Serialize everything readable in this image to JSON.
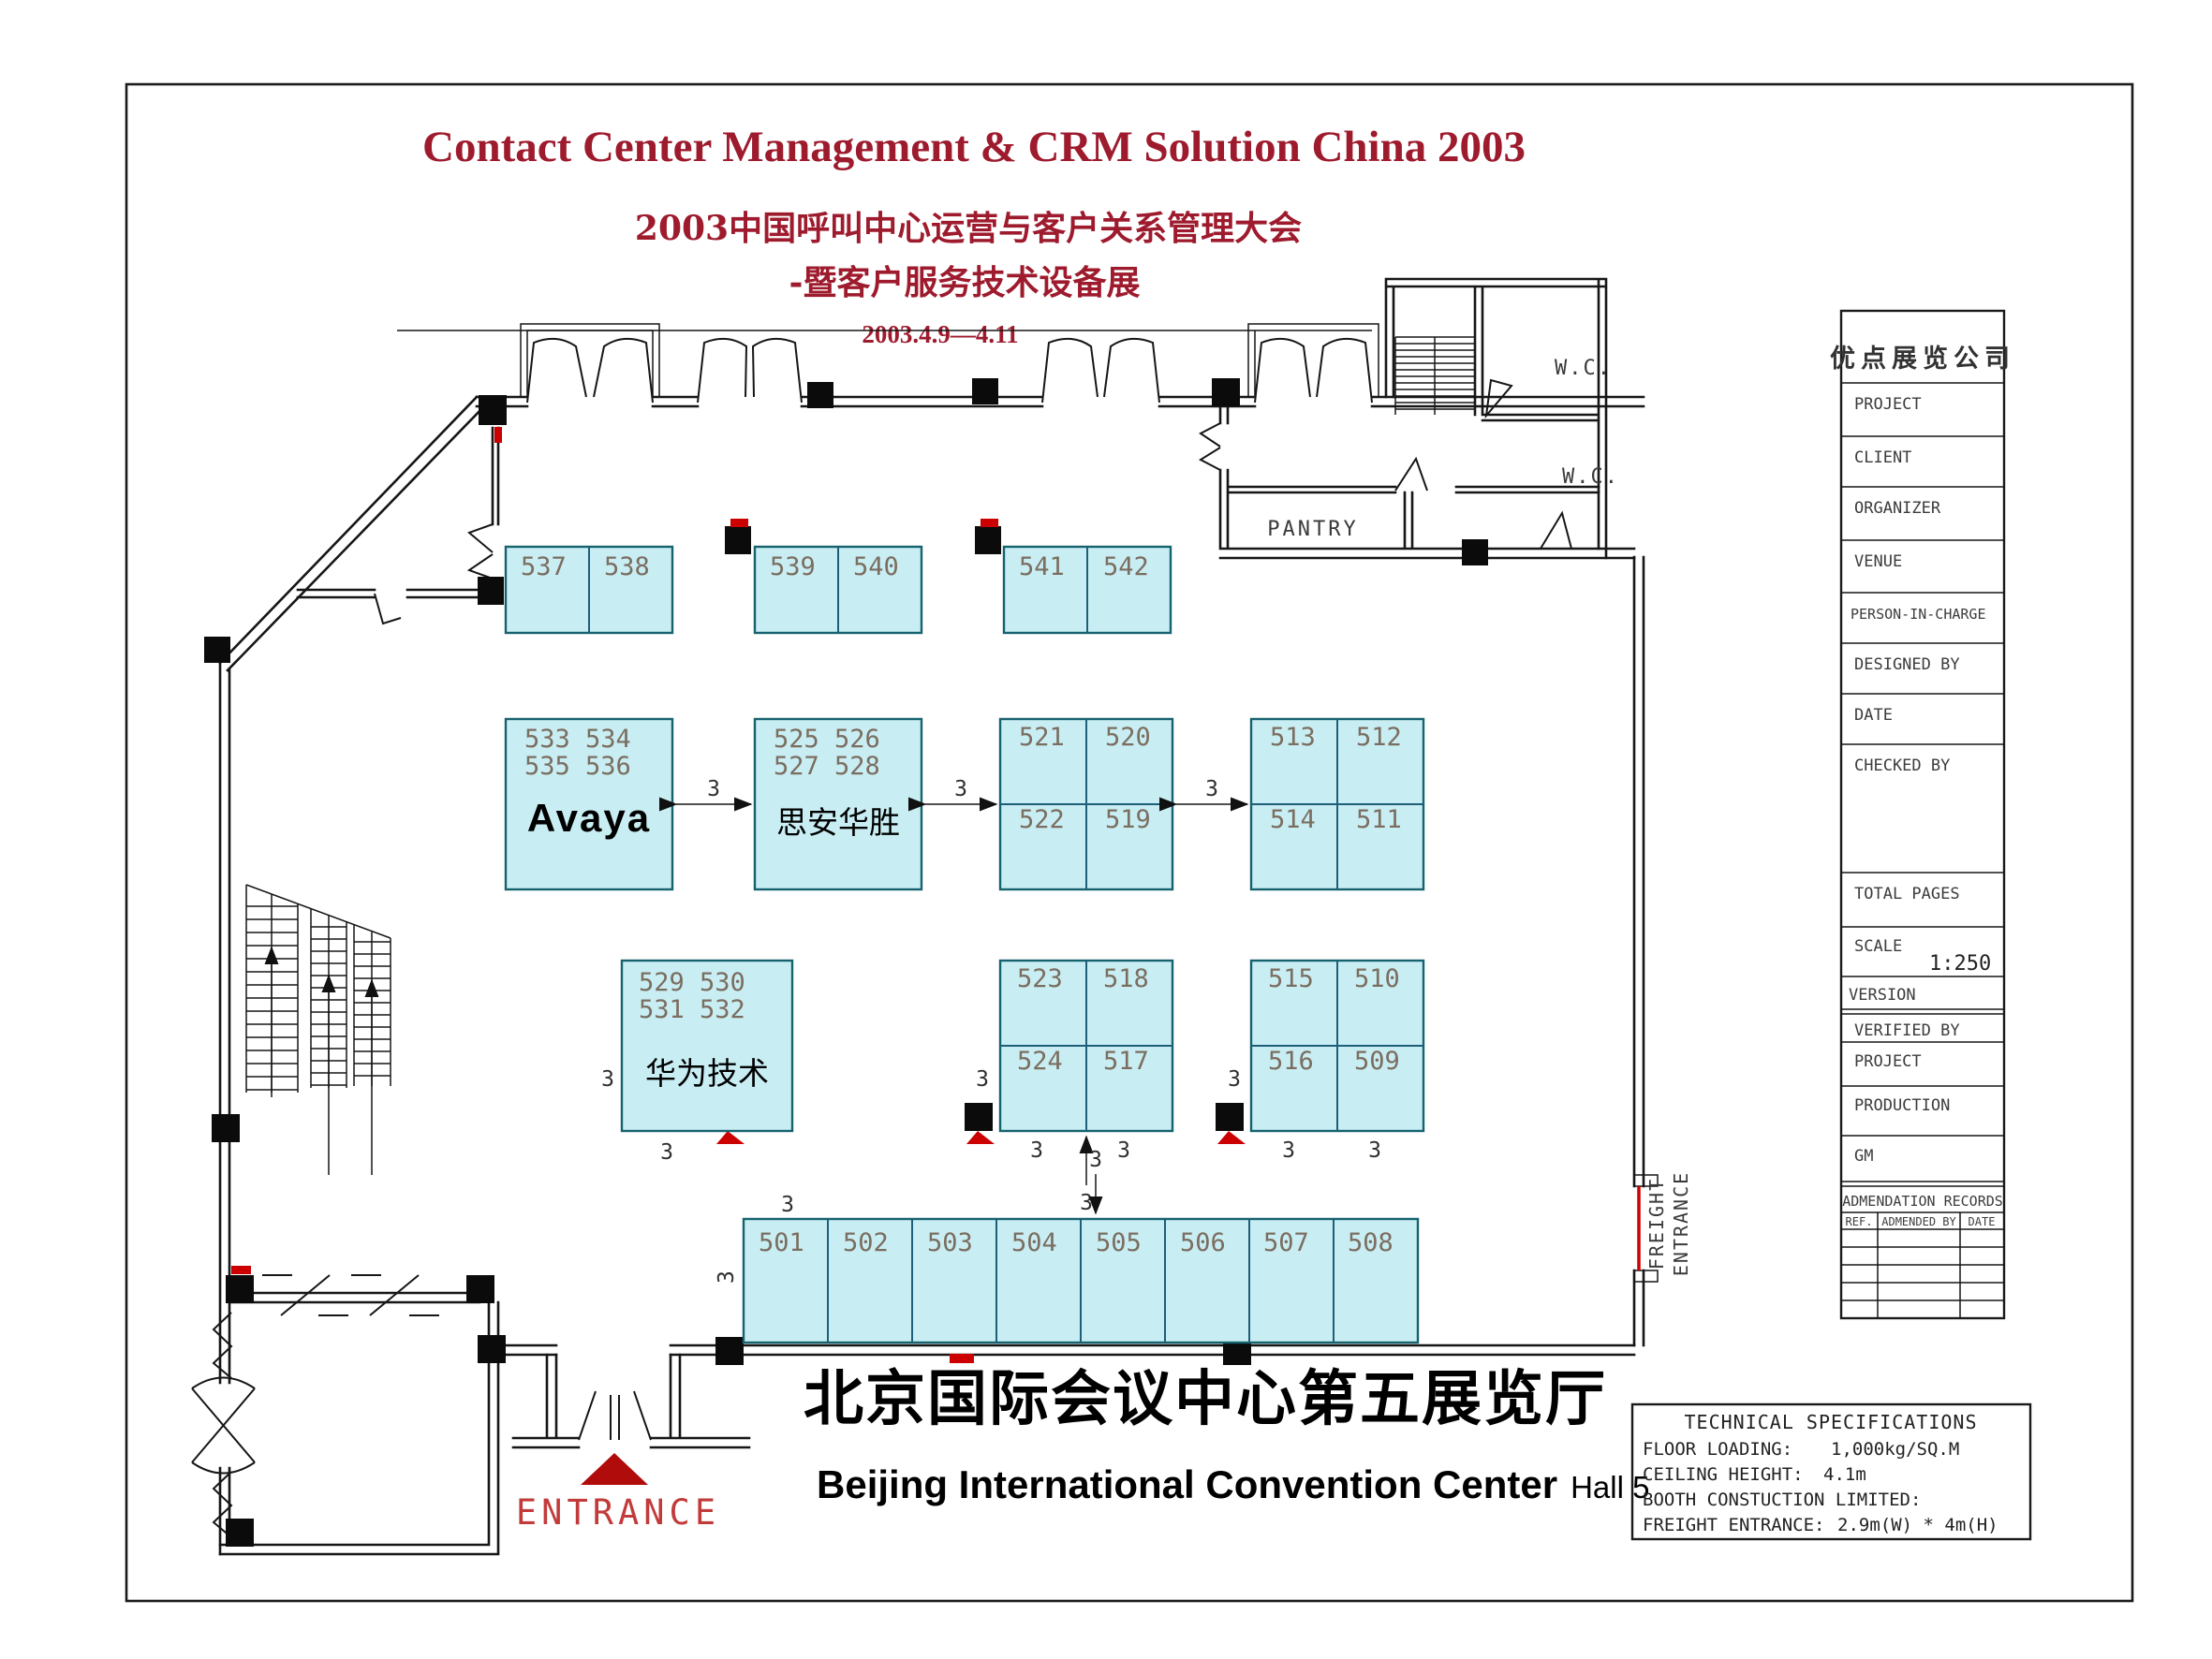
{
  "header": {
    "title": "Contact Center Management & CRM Solution China 2003",
    "subtitle1": "2003中国呼叫中心运营与客户关系管理大会",
    "subtitle2": "-暨客户服务技术设备展",
    "dates": "2003.4.9—4.11"
  },
  "venue": {
    "cn": "北京国际会议中心第五展览厅",
    "en": "Beijing International Convention Center",
    "hall": "Hall 5"
  },
  "rooms": {
    "wc": "W.C.",
    "pantry": "PANTRY",
    "entrance": "ENTRANCE",
    "freight_line1": "FREIGHT",
    "freight_line2": "ENTRANCE"
  },
  "dim": {
    "label": "3"
  },
  "booths": {
    "top": [
      "537",
      "538",
      "539",
      "540",
      "541",
      "542"
    ],
    "avaya": {
      "nums1": "533 534",
      "nums2": "535 536",
      "name": "Avaya"
    },
    "sian": {
      "nums1": "525 526",
      "nums2": "527 528",
      "name": "思安华胜"
    },
    "blockC": [
      "521",
      "520",
      "522",
      "519"
    ],
    "blockD": [
      "513",
      "512",
      "514",
      "511"
    ],
    "huawei": {
      "nums1": "529 530",
      "nums2": "531 532",
      "name": "华为技术"
    },
    "blockE": [
      "523",
      "518",
      "524",
      "517"
    ],
    "blockF": [
      "515",
      "510",
      "516",
      "509"
    ],
    "bottom": [
      "501",
      "502",
      "503",
      "504",
      "505",
      "506",
      "507",
      "508"
    ]
  },
  "title_block": {
    "company": "优点展览公司",
    "rows": [
      "PROJECT",
      "CLIENT",
      "ORGANIZER",
      "VENUE",
      "PERSON-IN-CHARGE",
      "DESIGNED BY",
      "DATE",
      "CHECKED BY",
      "TOTAL PAGES"
    ],
    "scale_label": "SCALE",
    "scale_value": "1:250",
    "version_label": "VERSION",
    "verified_by": "VERIFIED BY",
    "project2": "PROJECT",
    "production": "PRODUCTION",
    "gm": "GM",
    "amend_title": "ADMENDATION RECORDS",
    "amend_cols": [
      "REF.",
      "ADMENDED BY",
      "DATE"
    ]
  },
  "tech": {
    "title": "TECHNICAL SPECIFICATIONS",
    "l1": "FLOOR LOADING:",
    "v1": "1,000kg/SQ.M",
    "l2": "CEILING HEIGHT:",
    "v2": "4.1m",
    "l3": "BOOTH CONSTUCTION LIMITED:",
    "l4": "FREIGHT ENTRANCE:",
    "v4": "2.9m(W) * 4m(H)"
  },
  "colors": {
    "booth_fill": "#c8eef3",
    "booth_border": "#16626f",
    "title_red": "#9e1b2e",
    "accent_red": "#cc0000"
  }
}
